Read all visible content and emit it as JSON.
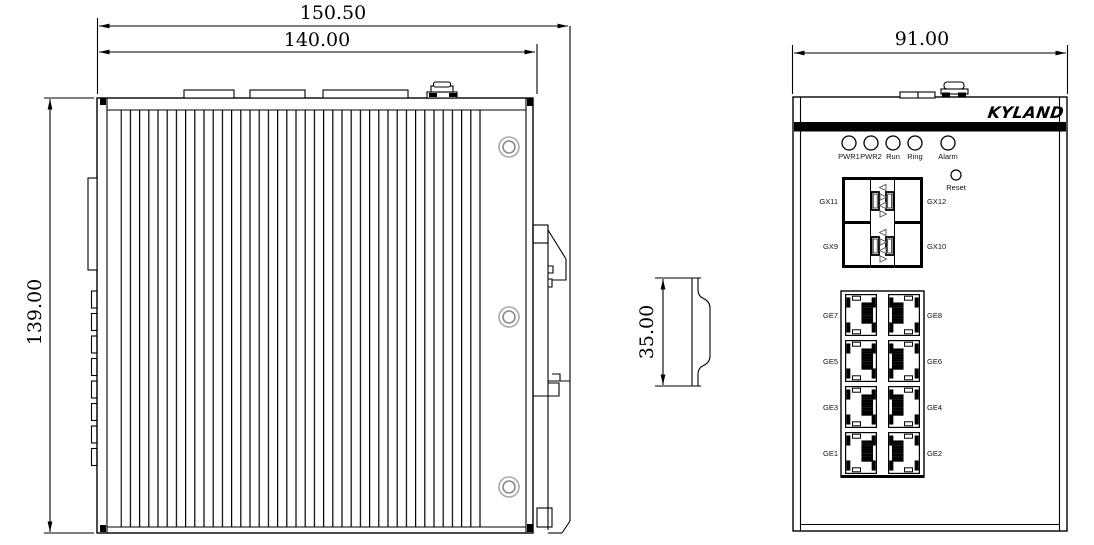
{
  "dimensions": {
    "overall_width": "150.50",
    "body_width": "140.00",
    "height": "139.00",
    "din_rail_height": "35.00",
    "front_width": "91.00"
  },
  "front_panel": {
    "brand": "KYLAND",
    "led_labels": [
      "PWR1",
      "PWR2",
      "Run",
      "Ring"
    ],
    "alarm_label": "Alarm",
    "reset_label": "Reset",
    "sfp_labels": {
      "top_left": "GX11",
      "top_right": "GX12",
      "bottom_left": "GX9",
      "bottom_right": "GX10"
    },
    "ge_left_labels": [
      "GE7",
      "GE5",
      "GE3",
      "GE1"
    ],
    "ge_right_labels": [
      "GE8",
      "GE6",
      "GE4",
      "GE2"
    ]
  },
  "colors": {
    "line": "#000000",
    "background": "#ffffff",
    "panel_bar": "#000000",
    "screw_ring": "#a9a9a9"
  }
}
